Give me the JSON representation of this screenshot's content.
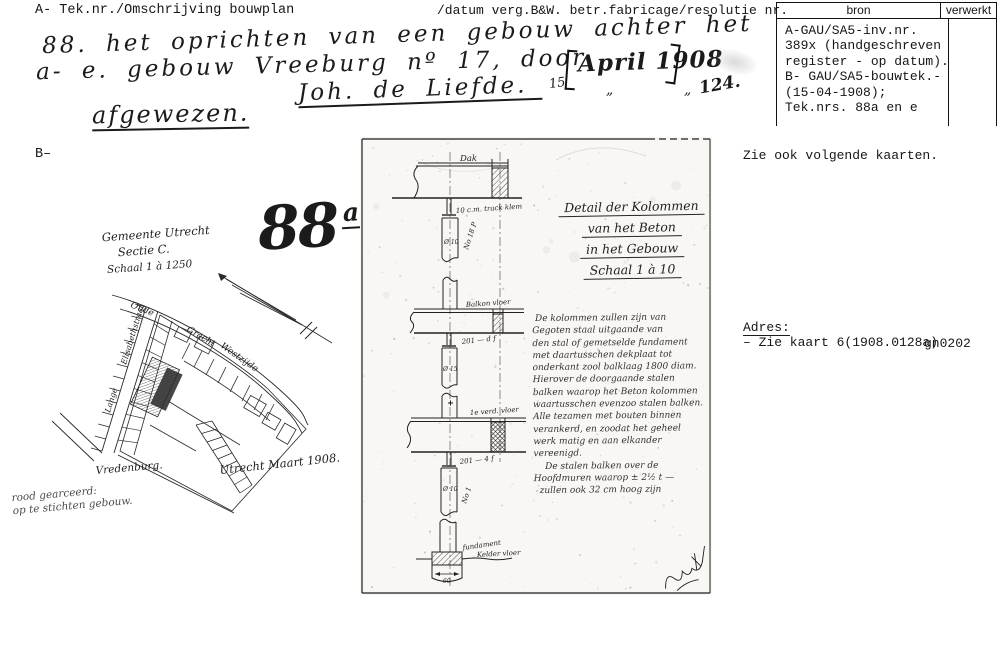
{
  "colors": {
    "ink": "#1b1b1b",
    "typed": "#161616",
    "paper": "#ffffff",
    "faded": "#4c4c4c"
  },
  "header": {
    "left": "A- Tek.nr./Omschrijving bouwplan",
    "middle": "/datum verg.B&W. betr.fabricage/resolutie nr.",
    "section_b": "B–"
  },
  "source_table": {
    "col1": "bron",
    "col2": "verwerkt",
    "bron_lines": [
      "A-GAU/SA5-inv.nr.",
      "389x (handgeschreven",
      "register - op datum).",
      "B- GAU/SA5-bouwtek.-",
      "(15-04-1908);",
      "Tek.nrs. 88a en e"
    ],
    "verwerkt_value": ""
  },
  "entry": {
    "line1": "88. het oprichten van een gebouw achter het",
    "line2": "a- e. gebouw Vreeburg nº 17, door",
    "applicant": "Joh. de Liefde.",
    "decision": "afgewezen.",
    "date_day": "15",
    "date_bracketed": "April 1908",
    "ditto1": "„",
    "ditto2": "„",
    "resolution_nr": "124."
  },
  "notes": {
    "see_also": "Zie ook volgende kaarten.",
    "address_label": "Adres:",
    "address_value": "– Zie kaart 6(1908.0128a)",
    "code": "gn0202"
  },
  "card_number": {
    "big": "88",
    "suffix": "a"
  },
  "map": {
    "title_lines": [
      "Gemeente Utrecht",
      "Sectie C.",
      "Schaal 1 à 1250"
    ],
    "street_oude": "Oude",
    "street_gracht": "Gracht",
    "street_westzijde": "Westzijde",
    "street_elisabeth": "Elisabethstraat",
    "street_lange": "Lange",
    "street_vredenburg": "Vredenburg.",
    "dated": "Utrecht Maart 1908.",
    "legend_lines": [
      "rood gearceerd:",
      "op te stichten gebouw."
    ]
  },
  "drawing": {
    "title_lines": [
      "Detail der Kolommen",
      "van het Beton",
      "in het Gebouw",
      "Schaal 1 à 10"
    ],
    "paragraph_lines": [
      " De kolommen zullen zijn van",
      "Gegoten staal uitgaande van",
      "den stal of gemetselde fundament",
      "met daartusschen dekplaat tot",
      "onderkant zool balklaag 1800 diam.",
      "Hierover de doorgaande stalen",
      "balken waarop het Beton kolommen",
      "waartusschen evenzoo stalen balken.",
      "Alle tezamen met bouten binnen",
      "verankerd, en zoodat het geheel",
      "werk matig en aan elkander",
      "vereenigd.",
      "    De stalen balken over de",
      "Hoofdmuren waarop ± 2½ t —",
      "  zullen ook 32 cm hoog zijn"
    ],
    "labels": {
      "dak": "Dak",
      "beam1_note": "10 c.m. track klem",
      "balkon": "Balkon vloer",
      "note2": "201 — d f",
      "verd": "1e verd. vloer",
      "note3": "201 — 4 f",
      "kelder": "Kelder vloer",
      "fundament": "fundament",
      "dim": "60",
      "d10a": "Ø 10",
      "d15": "Ø 15",
      "d10b": "Ø 10",
      "no18": "No 18 P",
      "no1": "No 1"
    }
  }
}
